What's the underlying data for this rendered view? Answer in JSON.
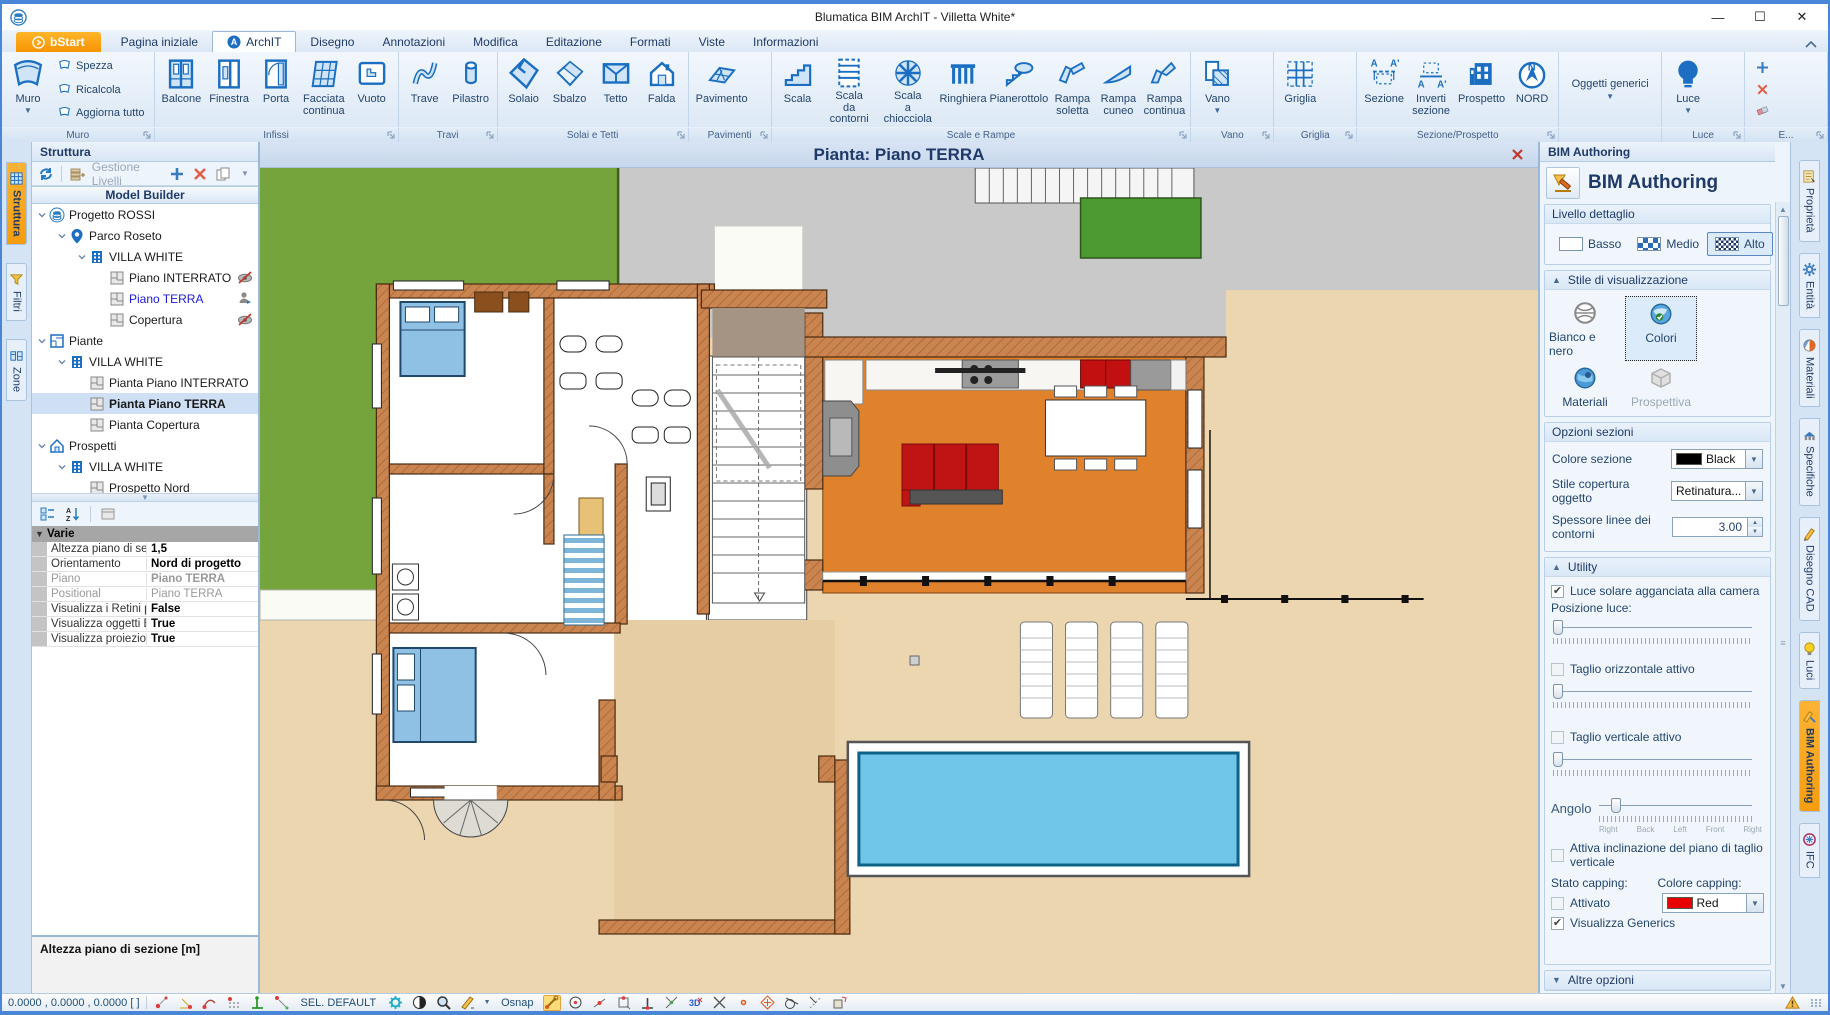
{
  "window": {
    "title": "Blumatica BIM ArchIT - Villetta White*",
    "minimize": "—",
    "maximize": "☐",
    "close": "✕"
  },
  "ribbon": {
    "tabs": [
      {
        "label": "bStart",
        "style": "bstart"
      },
      {
        "label": "Pagina iniziale"
      },
      {
        "label": "ArchIT",
        "active": true
      },
      {
        "label": "Disegno"
      },
      {
        "label": "Annotazioni"
      },
      {
        "label": "Modifica"
      },
      {
        "label": "Editazione"
      },
      {
        "label": "Formati"
      },
      {
        "label": "Viste"
      },
      {
        "label": "Informazioni"
      }
    ],
    "groups": [
      {
        "label": "Muro",
        "launcher": true,
        "big": [
          {
            "label": "Muro",
            "icon": "muro",
            "arrow": true
          }
        ],
        "stack": [
          {
            "label": "Spezza",
            "icon": "wallmini"
          },
          {
            "label": "Ricalcola",
            "icon": "wallmini"
          },
          {
            "label": "Aggiorna tutto",
            "icon": "wallmini"
          }
        ]
      },
      {
        "label": "Infissi",
        "launcher": true,
        "big": [
          {
            "label": "Balcone",
            "icon": "balcone"
          },
          {
            "label": "Finestra",
            "icon": "finestra"
          },
          {
            "label": "Porta",
            "icon": "porta"
          },
          {
            "label": "Facciata continua",
            "icon": "facciata"
          },
          {
            "label": "Vuoto",
            "icon": "vuoto"
          }
        ]
      },
      {
        "label": "Travi",
        "launcher": true,
        "big": [
          {
            "label": "Trave",
            "icon": "trave"
          },
          {
            "label": "Pilastro",
            "icon": "pilastro"
          }
        ]
      },
      {
        "label": "Solai e Tetti",
        "launcher": true,
        "big": [
          {
            "label": "Solaio",
            "icon": "solaio"
          },
          {
            "label": "Sbalzo",
            "icon": "sbalzo"
          },
          {
            "label": "Tetto",
            "icon": "tetto"
          },
          {
            "label": "Falda",
            "icon": "falda"
          }
        ]
      },
      {
        "label": "Pavimenti",
        "launcher": true,
        "big": [
          {
            "label": "Pavimento",
            "icon": "pavimento"
          }
        ]
      },
      {
        "label": "Scale e Rampe",
        "launcher": true,
        "big": [
          {
            "label": "Scala",
            "icon": "scala"
          },
          {
            "label": "Scala da contorni",
            "icon": "scala2"
          },
          {
            "label": "Scala a chiocciola",
            "icon": "chiocciola"
          },
          {
            "label": "Ringhiera",
            "icon": "ringhiera"
          },
          {
            "label": "Pianerottolo",
            "icon": "pianerottolo"
          },
          {
            "label": "Rampa soletta",
            "icon": "rampa1"
          },
          {
            "label": "Rampa cuneo",
            "icon": "rampa2"
          },
          {
            "label": "Rampa continua",
            "icon": "rampa3"
          }
        ]
      },
      {
        "label": "Vano",
        "launcher": true,
        "big": [
          {
            "label": "Vano",
            "icon": "vano",
            "arrow": true
          }
        ]
      },
      {
        "label": "Griglia",
        "launcher": true,
        "big": [
          {
            "label": "Griglia",
            "icon": "griglia"
          }
        ]
      },
      {
        "label": "Sezione/Prospetto",
        "launcher": true,
        "big": [
          {
            "label": "Sezione",
            "icon": "sezione"
          },
          {
            "label": "Inverti sezione",
            "icon": "inverti"
          },
          {
            "label": "Prospetto",
            "icon": "prospetto"
          },
          {
            "label": "NORD",
            "icon": "nord"
          }
        ]
      },
      {
        "label": "",
        "launcher": false,
        "big": [
          {
            "label": "Oggetti generici",
            "icon": "none",
            "arrow": true,
            "wide": true
          }
        ]
      },
      {
        "label": "Luce",
        "launcher": true,
        "big": [
          {
            "label": "Luce",
            "icon": "luce",
            "arrow": true
          }
        ]
      },
      {
        "label": "E...",
        "launcher": true,
        "iconstack": [
          "plus",
          "xred",
          "eraser"
        ]
      }
    ]
  },
  "leftTabs": [
    {
      "label": "Struttura",
      "icon": "ticon-grid",
      "active": true
    },
    {
      "label": "Filtri",
      "icon": "ticon-funnel"
    },
    {
      "label": "Zone",
      "icon": "ticon-zone"
    }
  ],
  "rightTabs": [
    {
      "label": "Proprietà",
      "icon": "ticon-prop"
    },
    {
      "label": "Entità",
      "icon": "ticon-gear"
    },
    {
      "label": "Materiali",
      "icon": "ticon-mat"
    },
    {
      "label": "Specifiche",
      "icon": "ticon-spec"
    },
    {
      "label": "Disegno CAD",
      "icon": "ticon-cad"
    },
    {
      "label": "Luci",
      "icon": "ticon-bulb"
    },
    {
      "label": "BIM Authoring",
      "icon": "ticon-bim",
      "active": true
    },
    {
      "label": "IFC",
      "icon": "ticon-ifc"
    }
  ],
  "structure": {
    "header": "Struttura",
    "gestione_label": "Gestione Livelli",
    "model_builder": "Model Builder",
    "tree": [
      {
        "d": 0,
        "icon": "project",
        "label": "Progetto ROSSI",
        "exp": true
      },
      {
        "d": 1,
        "icon": "pin",
        "label": "Parco Roseto",
        "exp": true
      },
      {
        "d": 2,
        "icon": "building",
        "label": "VILLA WHITE",
        "exp": true
      },
      {
        "d": 3,
        "icon": "floor",
        "label": "Piano INTERRATO",
        "right": "eyeoff"
      },
      {
        "d": 3,
        "icon": "floor",
        "label": "Piano TERRA",
        "blue": true,
        "right": "user"
      },
      {
        "d": 3,
        "icon": "floor",
        "label": "Copertura",
        "right": "eyeoff"
      },
      {
        "d": 0,
        "icon": "plans",
        "label": "Piante",
        "exp": true
      },
      {
        "d": 1,
        "icon": "building",
        "label": "VILLA WHITE",
        "exp": true
      },
      {
        "d": 2,
        "icon": "floor",
        "label": "Pianta Piano INTERRATO"
      },
      {
        "d": 2,
        "icon": "floor",
        "label": "Pianta Piano TERRA",
        "selected": true,
        "bold": true
      },
      {
        "d": 2,
        "icon": "floor",
        "label": "Pianta Copertura"
      },
      {
        "d": 0,
        "icon": "elev",
        "label": "Prospetti",
        "exp": true
      },
      {
        "d": 1,
        "icon": "building",
        "label": "VILLA WHITE",
        "exp": true
      },
      {
        "d": 2,
        "icon": "houseN",
        "label": "Prospetto Nord"
      },
      {
        "d": 2,
        "icon": "houseS",
        "label": "Prospetto Sud"
      },
      {
        "d": 2,
        "icon": "houseO",
        "label": "Prospetto Ovest"
      },
      {
        "d": 2,
        "icon": "houseE",
        "label": "Prospetto Est"
      },
      {
        "d": 0,
        "icon": "housegray",
        "label": "Sezioni",
        "exp": true
      },
      {
        "d": 1,
        "icon": "housegray",
        "label": "Sezione A - A' ( VILLA WHITE )"
      },
      {
        "d": 0,
        "icon": "folder",
        "label": "Tavole",
        "exp": true
      },
      {
        "d": 1,
        "icon": "tavola",
        "label": "Tavola a colori"
      }
    ]
  },
  "properties": {
    "category": "Varie",
    "rows": [
      {
        "label": "Altezza piano di sezi",
        "value": "1,5",
        "bold": true
      },
      {
        "label": "Orientamento",
        "value": "Nord di progetto",
        "bold": true
      },
      {
        "label": "Piano",
        "value": "Piano TERRA",
        "bold": true,
        "gray": true
      },
      {
        "label": "Positional",
        "value": "Piano TERRA",
        "gray": true
      },
      {
        "label": "Visualizza i Retini pe",
        "value": "False",
        "bold": true
      },
      {
        "label": "Visualizza oggetti BI",
        "value": "True",
        "bold": true
      },
      {
        "label": "Visualizza proiezioni",
        "value": "True",
        "bold": true
      }
    ],
    "description": "Altezza piano di sezione [m]"
  },
  "canvas": {
    "title": "Pianta: Piano TERRA"
  },
  "bim": {
    "header": "BIM Authoring",
    "title": "BIM Authoring",
    "livello": {
      "title": "Livello dettaglio",
      "options": [
        {
          "label": "Basso",
          "swatch": "low"
        },
        {
          "label": "Medio",
          "swatch": "med"
        },
        {
          "label": "Alto",
          "swatch": "high",
          "selected": true
        }
      ]
    },
    "stile": {
      "title": "Stile di visualizzazione",
      "options": [
        {
          "label": "Bianco e nero",
          "icon": "globebw"
        },
        {
          "label": "Colori",
          "icon": "globecolor",
          "selected": true
        },
        {
          "label": "Materiali",
          "icon": "globemat"
        },
        {
          "label": "Prospettiva",
          "icon": "cubegray",
          "disabled": true
        }
      ]
    },
    "opzioni": {
      "title": "Opzioni sezioni",
      "rows": [
        {
          "label": "Colore sezione",
          "type": "color",
          "value": "Black",
          "color": "#000000"
        },
        {
          "label": "Stile copertura oggetto",
          "type": "dropdown",
          "value": "Retinatura..."
        },
        {
          "label": "Spessore linee dei contorni",
          "type": "spinner",
          "value": "3.00"
        }
      ]
    },
    "utility": {
      "title": "Utility",
      "sun": {
        "label": "Luce solare agganciata alla camera",
        "checked": true
      },
      "pos_label": "Posizione luce:",
      "taglio_h": {
        "label": "Taglio orizzontale attivo",
        "checked": false
      },
      "taglio_v": {
        "label": "Taglio verticale attivo",
        "checked": false
      },
      "angolo_label": "Angolo",
      "angolo_ticks": [
        "Right",
        "Back",
        "Left",
        "Front",
        "Right"
      ],
      "inclinazione": {
        "label": "Attiva inclinazione del piano di taglio verticale",
        "checked": false
      },
      "stato_label": "Stato capping:",
      "colore_label": "Colore capping:",
      "attivato": {
        "label": "Attivato",
        "checked": false
      },
      "cap_color": {
        "value": "Red",
        "color": "#e60000"
      },
      "generics": {
        "label": "Visualizza Generics",
        "checked": true
      }
    },
    "altre_label": "Altre opzioni"
  },
  "status": {
    "coords": "0.0000 , 0.0000 , 0.0000 [ ]",
    "sel": "SEL. DEFAULT",
    "osnap": "Osnap"
  },
  "colors": {
    "accent_orange": "#f5a81c",
    "ribbon_blue": "#1b6ec2",
    "navy": "#1f3a68",
    "wall": "#c98450",
    "floor_orange": "#e0812c",
    "lawn": "#75a43d",
    "lawn_dark": "#4d9a33",
    "pool": "#70c6e8",
    "sofa_red": "#c01414",
    "bed_blue": "#8fc1e4",
    "beige": "#ecd6b0",
    "driveway_gray": "#c9c9c9"
  }
}
